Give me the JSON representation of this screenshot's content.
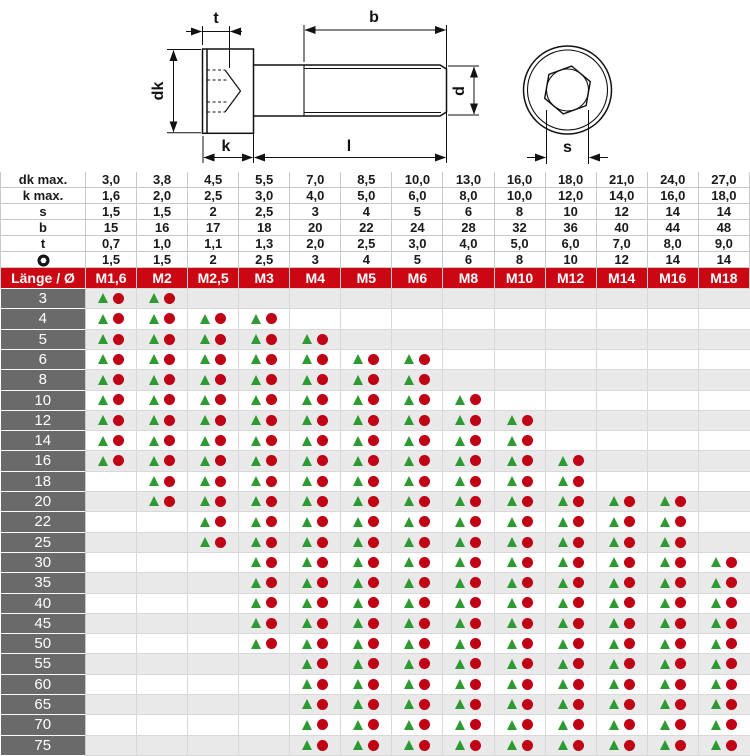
{
  "colors": {
    "accent_red": "#cb0714",
    "label_grey": "#6a6a6a",
    "row_alt_grey": "#e9e9e9",
    "marker_green": "#2e9b32",
    "marker_red": "#c00014",
    "grid_line": "#cccccc"
  },
  "drawing": {
    "labels": {
      "t": "t",
      "b": "b",
      "dk": "dk",
      "d": "d",
      "k": "k",
      "l": "l",
      "s": "s"
    }
  },
  "spec_table": {
    "rows": [
      {
        "label": "dk max.",
        "values": [
          "3,0",
          "3,8",
          "4,5",
          "5,5",
          "7,0",
          "8,5",
          "10,0",
          "13,0",
          "16,0",
          "18,0",
          "21,0",
          "24,0",
          "27,0"
        ]
      },
      {
        "label": "k max.",
        "values": [
          "1,6",
          "2,0",
          "2,5",
          "3,0",
          "4,0",
          "5,0",
          "6,0",
          "8,0",
          "10,0",
          "12,0",
          "14,0",
          "16,0",
          "18,0"
        ]
      },
      {
        "label": "s",
        "values": [
          "1,5",
          "1,5",
          "2",
          "2,5",
          "3",
          "4",
          "5",
          "6",
          "8",
          "10",
          "12",
          "14",
          "14"
        ]
      },
      {
        "label": "b",
        "values": [
          "15",
          "16",
          "17",
          "18",
          "20",
          "22",
          "24",
          "28",
          "32",
          "36",
          "40",
          "44",
          "48"
        ]
      },
      {
        "label": "t",
        "values": [
          "0,7",
          "1,0",
          "1,1",
          "1,3",
          "2,0",
          "2,5",
          "3,0",
          "4,0",
          "5,0",
          "6,0",
          "7,0",
          "8,0",
          "9,0"
        ]
      },
      {
        "label": "",
        "icon": "hex-socket-icon",
        "values": [
          "1,5",
          "1,5",
          "2",
          "2,5",
          "3",
          "4",
          "5",
          "6",
          "8",
          "10",
          "12",
          "14",
          "14"
        ]
      }
    ]
  },
  "matrix": {
    "header_label": "Länge / Ø",
    "columns": [
      "M1,6",
      "M2",
      "M2,5",
      "M3",
      "M4",
      "M5",
      "M6",
      "M8",
      "M10",
      "M12",
      "M14",
      "M16",
      "M18"
    ],
    "marker_icons": [
      "triangle-marker",
      "circle-marker"
    ],
    "rows": [
      {
        "length": "3",
        "cells": [
          1,
          1,
          0,
          0,
          0,
          0,
          0,
          0,
          0,
          0,
          0,
          0,
          0
        ]
      },
      {
        "length": "4",
        "cells": [
          1,
          1,
          1,
          1,
          0,
          0,
          0,
          0,
          0,
          0,
          0,
          0,
          0
        ]
      },
      {
        "length": "5",
        "cells": [
          1,
          1,
          1,
          1,
          1,
          0,
          0,
          0,
          0,
          0,
          0,
          0,
          0
        ]
      },
      {
        "length": "6",
        "cells": [
          1,
          1,
          1,
          1,
          1,
          1,
          1,
          0,
          0,
          0,
          0,
          0,
          0
        ]
      },
      {
        "length": "8",
        "cells": [
          1,
          1,
          1,
          1,
          1,
          1,
          1,
          0,
          0,
          0,
          0,
          0,
          0
        ]
      },
      {
        "length": "10",
        "cells": [
          1,
          1,
          1,
          1,
          1,
          1,
          1,
          1,
          0,
          0,
          0,
          0,
          0
        ]
      },
      {
        "length": "12",
        "cells": [
          1,
          1,
          1,
          1,
          1,
          1,
          1,
          1,
          1,
          0,
          0,
          0,
          0
        ]
      },
      {
        "length": "14",
        "cells": [
          1,
          1,
          1,
          1,
          1,
          1,
          1,
          1,
          1,
          0,
          0,
          0,
          0
        ]
      },
      {
        "length": "16",
        "cells": [
          1,
          1,
          1,
          1,
          1,
          1,
          1,
          1,
          1,
          1,
          0,
          0,
          0
        ]
      },
      {
        "length": "18",
        "cells": [
          0,
          1,
          1,
          1,
          1,
          1,
          1,
          1,
          1,
          1,
          0,
          0,
          0
        ]
      },
      {
        "length": "20",
        "cells": [
          0,
          1,
          1,
          1,
          1,
          1,
          1,
          1,
          1,
          1,
          1,
          1,
          0
        ]
      },
      {
        "length": "22",
        "cells": [
          0,
          0,
          1,
          1,
          1,
          1,
          1,
          1,
          1,
          1,
          1,
          1,
          0
        ]
      },
      {
        "length": "25",
        "cells": [
          0,
          0,
          1,
          1,
          1,
          1,
          1,
          1,
          1,
          1,
          1,
          1,
          0
        ]
      },
      {
        "length": "30",
        "cells": [
          0,
          0,
          0,
          1,
          1,
          1,
          1,
          1,
          1,
          1,
          1,
          1,
          1
        ]
      },
      {
        "length": "35",
        "cells": [
          0,
          0,
          0,
          1,
          1,
          1,
          1,
          1,
          1,
          1,
          1,
          1,
          1
        ]
      },
      {
        "length": "40",
        "cells": [
          0,
          0,
          0,
          1,
          1,
          1,
          1,
          1,
          1,
          1,
          1,
          1,
          1
        ]
      },
      {
        "length": "45",
        "cells": [
          0,
          0,
          0,
          1,
          1,
          1,
          1,
          1,
          1,
          1,
          1,
          1,
          1
        ]
      },
      {
        "length": "50",
        "cells": [
          0,
          0,
          0,
          1,
          1,
          1,
          1,
          1,
          1,
          1,
          1,
          1,
          1
        ]
      },
      {
        "length": "55",
        "cells": [
          0,
          0,
          0,
          0,
          1,
          1,
          1,
          1,
          1,
          1,
          1,
          1,
          1
        ]
      },
      {
        "length": "60",
        "cells": [
          0,
          0,
          0,
          0,
          1,
          1,
          1,
          1,
          1,
          1,
          1,
          1,
          1
        ]
      },
      {
        "length": "65",
        "cells": [
          0,
          0,
          0,
          0,
          1,
          1,
          1,
          1,
          1,
          1,
          1,
          1,
          1
        ]
      },
      {
        "length": "70",
        "cells": [
          0,
          0,
          0,
          0,
          1,
          1,
          1,
          1,
          1,
          1,
          1,
          1,
          1
        ]
      },
      {
        "length": "75",
        "cells": [
          0,
          0,
          0,
          0,
          1,
          1,
          1,
          1,
          1,
          1,
          1,
          1,
          1
        ]
      }
    ]
  }
}
